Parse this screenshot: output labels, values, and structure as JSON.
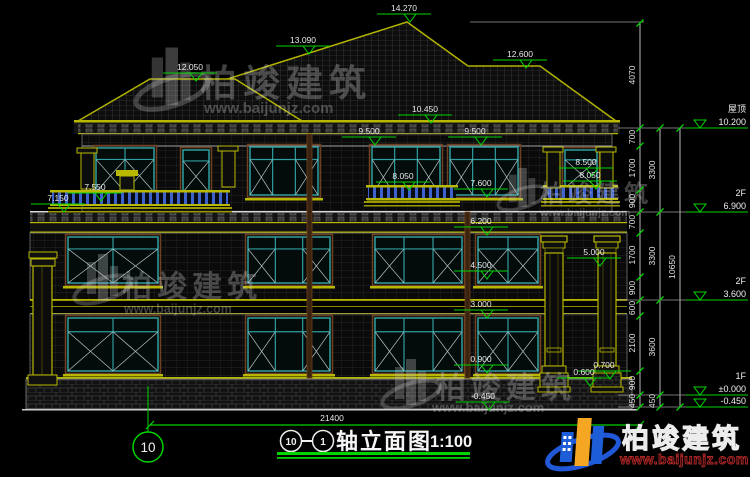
{
  "title": {
    "axis_start": "10",
    "axis_end": "1",
    "name": "轴立面图",
    "scale": "1:100"
  },
  "axis_bubble_bottom": "10",
  "dim_width": "21400",
  "right_dims": {
    "roof_height": "4070",
    "segs": [
      "700",
      "1700",
      "900",
      "700",
      "1700",
      "900",
      "600",
      "2100",
      "900",
      "450"
    ],
    "totals": [
      "3300",
      "3300",
      "3600",
      "450"
    ],
    "overall": "10650"
  },
  "level_flags": [
    {
      "label": "屋顶",
      "value": "10.200"
    },
    {
      "label": "2F",
      "value": "6.900"
    },
    {
      "label": "2F",
      "value": "3.600"
    },
    {
      "label": "1F",
      "value": "±0.000"
    },
    {
      "label": "",
      "value": "-0.450"
    }
  ],
  "spot_levels": {
    "peak": "14.270",
    "ridge_l1": "13.090",
    "ridge_l2": "12.050",
    "ridge_r": "12.600",
    "eave": "10.450",
    "cornice_l": "9.500",
    "cornice_r": "9.500",
    "balc_r_a": "8.500",
    "balc_r_b": "8.050",
    "balc_c_a": "8.050",
    "balc_c_b": "7.600",
    "balc_l_a": "7.550",
    "balc_l_b": "7.150",
    "f3": "6.200",
    "col_cap": "5.000",
    "w2_sill": "4.500",
    "w1_head": "3.000",
    "w1_sill": "0.900",
    "ped_a": "0.700",
    "ped_b": "0.600",
    "base": "-0.450"
  },
  "watermark": {
    "name": "柏竣建筑",
    "url": "www.baijunjz.com"
  },
  "brand": {
    "name": "柏竣建筑",
    "url": "www.baijunjz.com"
  },
  "colors": {
    "dim_green": "#00d400",
    "trim_yellow": "#b8b800",
    "window_teal": "#2f9e9e",
    "railing_blue": "#3e62cc",
    "logo_blue": "#1d5dd8",
    "logo_orange": "#f5a623",
    "logo_red": "#b22828"
  }
}
